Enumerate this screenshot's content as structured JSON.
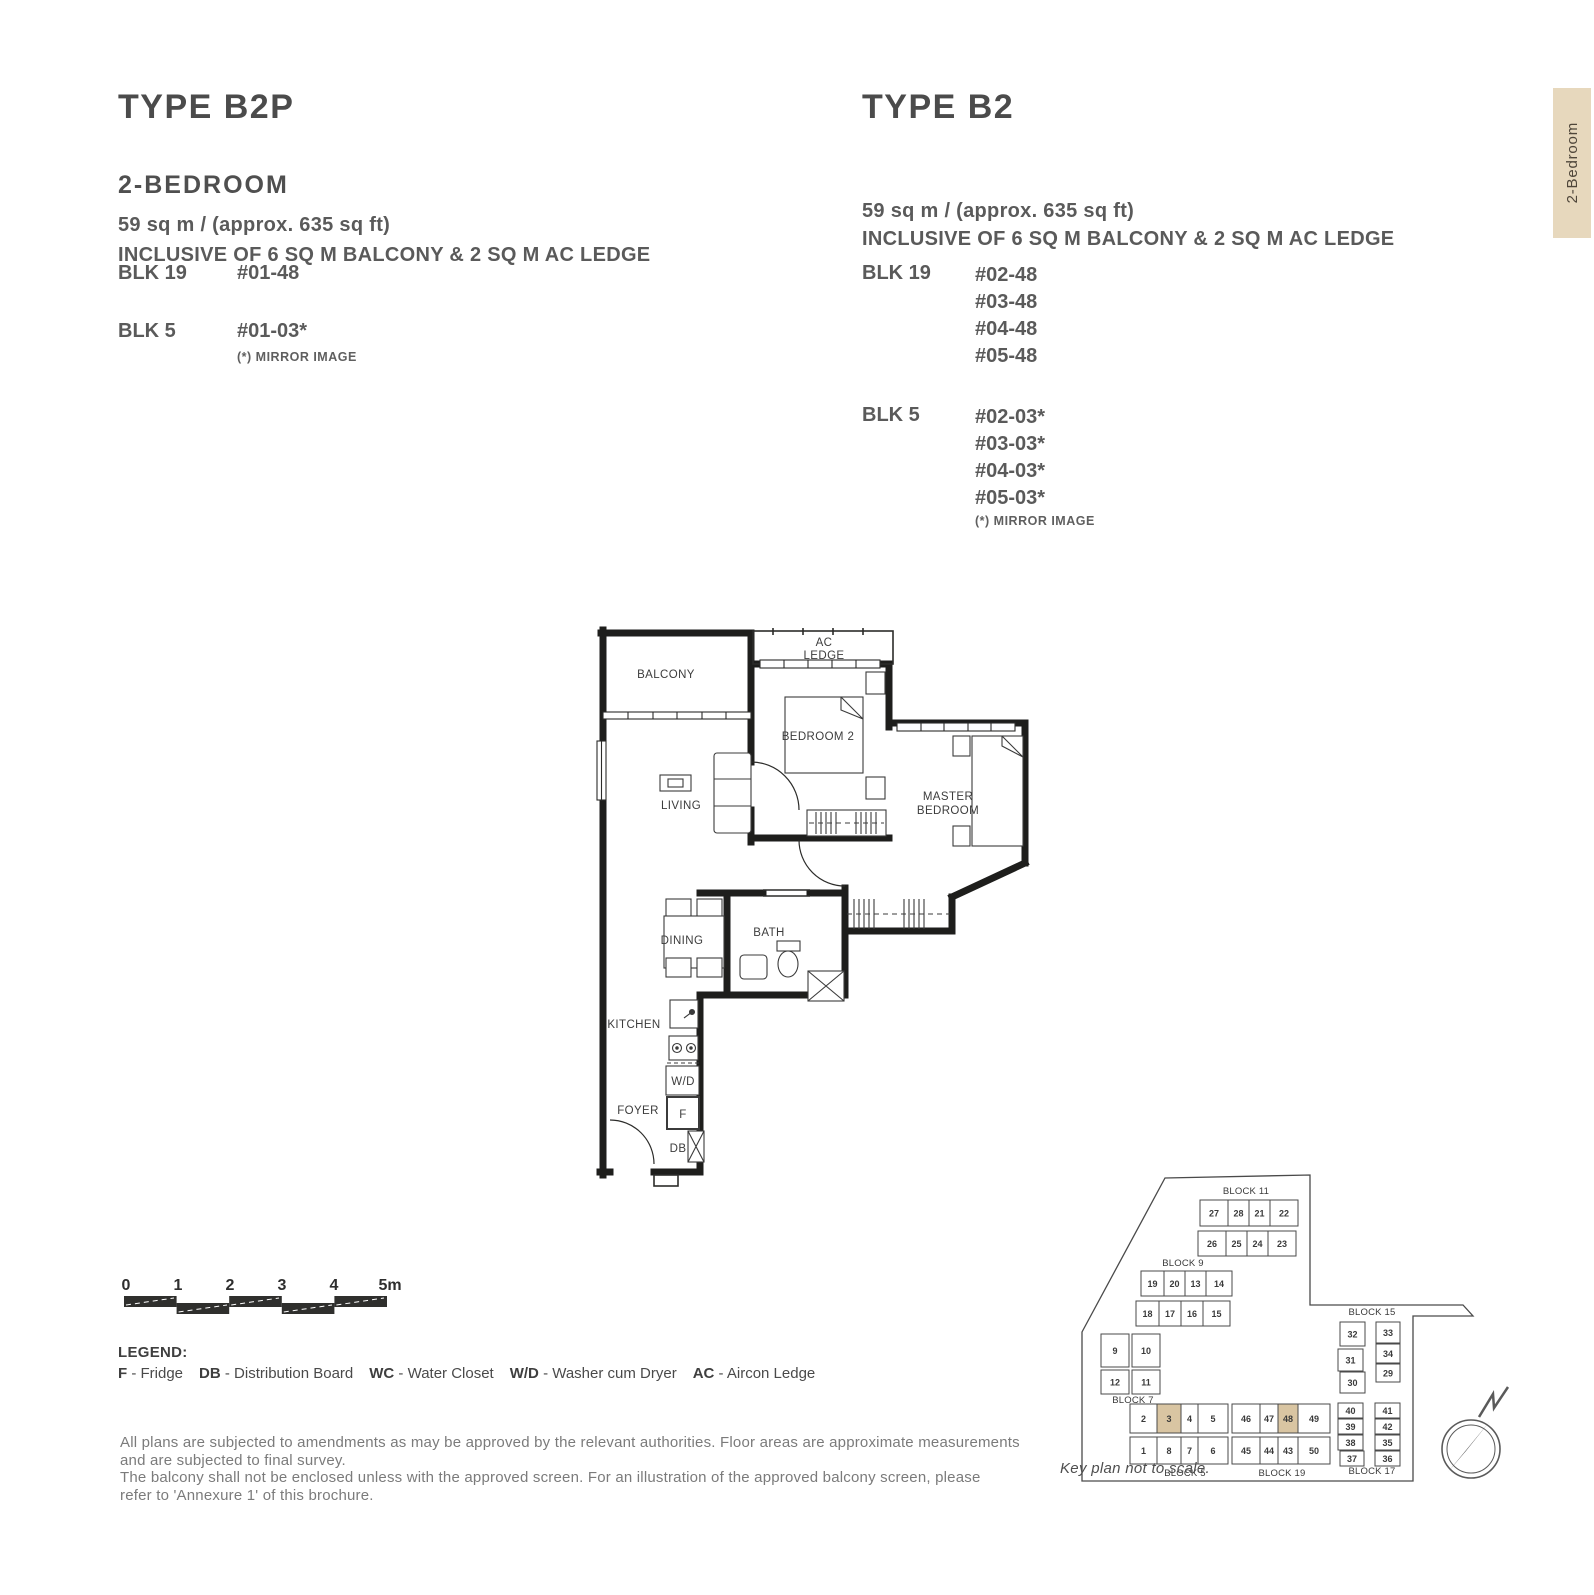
{
  "tab": {
    "label": "2-Bedroom",
    "bg": "#e7d8bd"
  },
  "left_column": {
    "title": "TYPE B2P",
    "subtitle": "2-BEDROOM",
    "area": "59 sq m / (approx. 635 sq ft)",
    "inclusive": "INCLUSIVE OF 6 SQ M BALCONY & 2 SQ M AC LEDGE",
    "blocks": [
      {
        "name": "BLK 19",
        "units": [
          "#01-48"
        ]
      },
      {
        "name": "BLK 5",
        "units": [
          "#01-03*"
        ]
      }
    ],
    "mirror_note": "(*) MIRROR IMAGE"
  },
  "right_column": {
    "title": "TYPE B2",
    "area": "59 sq m / (approx. 635 sq ft)",
    "inclusive": "INCLUSIVE OF 6 SQ M BALCONY & 2 SQ M AC LEDGE",
    "blocks": [
      {
        "name": "BLK 19",
        "units": [
          "#02-48",
          "#03-48",
          "#04-48",
          "#05-48"
        ]
      },
      {
        "name": "BLK 5",
        "units": [
          "#02-03*",
          "#03-03*",
          "#04-03*",
          "#05-03*"
        ]
      }
    ],
    "mirror_note": "(*) MIRROR IMAGE"
  },
  "floorplan": {
    "labels": {
      "balcony": "BALCONY",
      "ac1": "AC",
      "ac2": "LEDGE",
      "bedroom2": "BEDROOM 2",
      "master1": "MASTER",
      "master2": "BEDROOM",
      "living": "LIVING",
      "dining": "DINING",
      "bath": "BATH",
      "kitchen": "KITCHEN",
      "wd": "W/D",
      "foyer": "FOYER",
      "f": "F",
      "db": "DB"
    }
  },
  "scalebar": {
    "labels": [
      "0",
      "1",
      "2",
      "3",
      "4",
      "5m"
    ]
  },
  "legend": {
    "title": "LEGEND:",
    "items": [
      {
        "abbr": "F",
        "desc": "Fridge"
      },
      {
        "abbr": "DB",
        "desc": "Distribution Board"
      },
      {
        "abbr": "WC",
        "desc": "Water Closet"
      },
      {
        "abbr": "W/D",
        "desc": "Washer cum Dryer"
      },
      {
        "abbr": "AC",
        "desc": "Aircon Ledge"
      }
    ]
  },
  "disclaimer": {
    "lines": [
      "All plans are subjected to amendments as may be approved by the relevant authorities. Floor areas are approximate measurements",
      "and are subjected to final survey.",
      "The balcony shall not be enclosed unless with the approved screen. For an illustration of the approved balcony screen, please",
      "refer to 'Annexure 1' of this brochure."
    ]
  },
  "keyplan": {
    "caption": "Key plan not to scale.",
    "highlight_color": "#d9c5a2",
    "highlighted_units": [
      "3",
      "48"
    ],
    "compass": {
      "north_label": "N"
    },
    "blocks": [
      {
        "label": "BLOCK 11",
        "units": [
          "27",
          "28",
          "21",
          "22",
          "26",
          "25",
          "24",
          "23"
        ]
      },
      {
        "label": "BLOCK 9",
        "units": [
          "19",
          "20",
          "13",
          "14",
          "18",
          "17",
          "16",
          "15"
        ]
      },
      {
        "label": "BLOCK 7",
        "units": [
          "9",
          "10",
          "12",
          "11"
        ]
      },
      {
        "label": "BLOCK 5",
        "units": [
          "2",
          "3",
          "4",
          "5",
          "1",
          "8",
          "7",
          "6"
        ]
      },
      {
        "label": "BLOCK 19",
        "units": [
          "46",
          "47",
          "48",
          "49",
          "45",
          "44",
          "43",
          "50"
        ]
      },
      {
        "label": "BLOCK 15",
        "units": [
          "32",
          "33",
          "31",
          "34",
          "30",
          "29"
        ]
      },
      {
        "label": "BLOCK 17",
        "units": [
          "40",
          "41",
          "39",
          "42",
          "38",
          "35",
          "37",
          "36"
        ]
      }
    ]
  }
}
